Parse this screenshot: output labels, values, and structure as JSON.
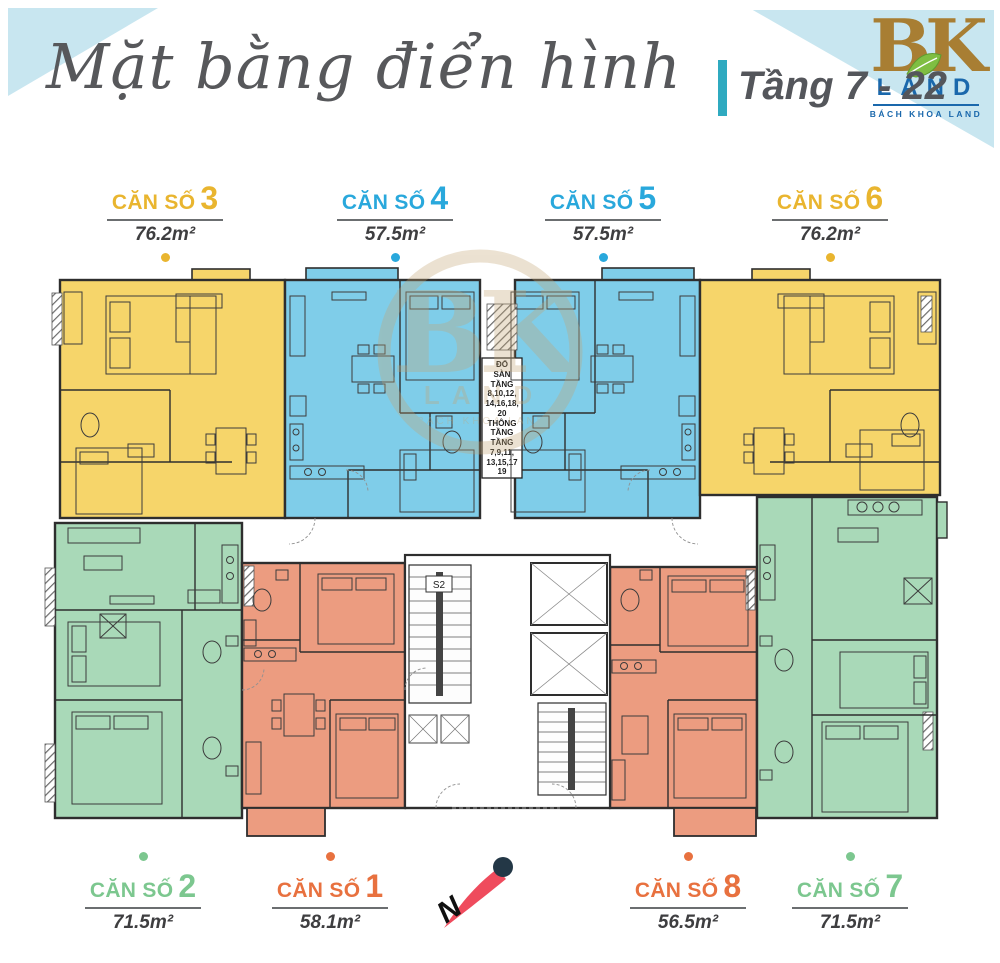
{
  "header": {
    "title": "Mặt bằng điển hình",
    "floor_range": "Tầng 7 - 22",
    "logo": {
      "mark": "BK",
      "word": "LAND",
      "tagline": "BÁCH KHOA LAND"
    }
  },
  "units": {
    "top": [
      {
        "label": "CĂN SỐ",
        "number": "3",
        "area": "76.2m²",
        "color": "#E9B52F"
      },
      {
        "label": "CĂN SỐ",
        "number": "4",
        "area": "57.5m²",
        "color": "#29A8DC"
      },
      {
        "label": "CĂN SỐ",
        "number": "5",
        "area": "57.5m²",
        "color": "#29A8DC"
      },
      {
        "label": "CĂN SỐ",
        "number": "6",
        "area": "76.2m²",
        "color": "#E9B52F"
      }
    ],
    "bottom": [
      {
        "label": "CĂN SỐ",
        "number": "2",
        "area": "71.5m²",
        "color": "#7CC78F"
      },
      {
        "label": "CĂN SỐ",
        "number": "1",
        "area": "58.1m²",
        "color": "#E8713F"
      },
      {
        "label": "CĂN SỐ",
        "number": "8",
        "area": "56.5m²",
        "color": "#E8713F"
      },
      {
        "label": "CĂN SỐ",
        "number": "7",
        "area": "71.5m²",
        "color": "#7CC78F"
      }
    ]
  },
  "plan": {
    "core_note": "ĐỔ\nSÀN\nTẦNG\n8,10,12,\n14,16,18,\n20\nTHÔNG\nTẦNG\nTẦNG\n7,9,11,\n13,15,17\n19",
    "stair_label": "S2",
    "watermark": {
      "mark": "BK",
      "word": "LAND",
      "tagline": "BACH KHOA LAND"
    }
  },
  "compass": {
    "north": "N"
  },
  "colors": {
    "unit_yellow": "#F6D56A",
    "unit_blue": "#7FCDE9",
    "unit_green": "#A9D9B8",
    "unit_orange": "#EC9C80",
    "label_yellow": "#E9B52F",
    "label_blue": "#29A8DC",
    "label_green": "#7CC78F",
    "label_orange": "#E8713F",
    "accent_teal": "#2FAAC0",
    "corner_blue": "#C8E6F0",
    "title_gray": "#57585B",
    "logo_gold": "#A87E33",
    "logo_blue": "#1A68AC",
    "leaf_green": "#7FBE42",
    "compass_red": "#EF4B5D",
    "compass_navy": "#233746",
    "wall": "#2E2E2E"
  }
}
